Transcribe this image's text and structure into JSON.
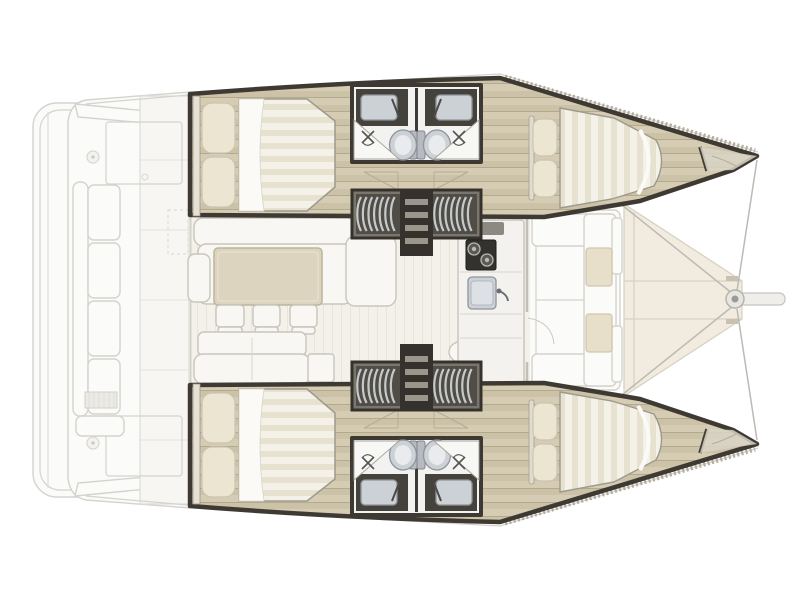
{
  "page": {
    "title": "Catamaran deck and accommodation plan"
  },
  "diagram": {
    "type": "boat-floorplan",
    "vessel": "four-cabin sailing catamaran",
    "view": "overhead plan",
    "orientation": {
      "bow": "right",
      "stern": "left",
      "top_hull": "port",
      "bottom_hull": "starboard"
    },
    "counts": {
      "double_cabins": 4,
      "bathrooms": 4,
      "toilets": 4,
      "showers": 4,
      "sinks": 4,
      "companionway_stairs": 2,
      "galley_burners": 2,
      "salon_stools": 3,
      "fore_cockpit_cushions": 2,
      "aft_bench_cushions": 4
    },
    "areas": {
      "boat": "Catamaran layout plan, bow to the right",
      "swim_platform": "Swim platform",
      "aft_cockpit": "Aft cockpit deck",
      "aft_bench": "Aft cockpit bench seating",
      "aft_wall": "Salon aft bulkhead with sliding door",
      "salon": "Salon",
      "l_sofa": "L-shaped salon sofa",
      "left_armrest": "Sofa end seat",
      "dining_table": "Dining table",
      "stools": "Three stools",
      "aft_sofa": "Aft-facing salon sofa",
      "side_cube": "Side table",
      "oval_seat": "Galley seat",
      "galley": "Galley counter",
      "stove": "Two-burner stove",
      "galley_sink": "Galley sink",
      "port_hull": "Port hull: aft double cabin, twin bathrooms, forward double cabin",
      "starboard_hull": "Starboard hull: aft double cabin, twin bathrooms, forward double cabin",
      "aft_cabin_bed": "Aft double berth with two pillows",
      "forward_cabin_bed": "Forward double berth with two pillows",
      "bathroom_block": "Back-to-back bathrooms with sinks, toilets and showers",
      "stairs": "Companionway steps down into hull",
      "fore_cockpit": "Forward cockpit lounge with cushions",
      "foredeck": "Foredeck between hulls",
      "bowsprit": "Bowsprit fitting and rigging lines"
    }
  },
  "colors": {
    "wall": "#3e3a33",
    "wood": "#cbc2a7",
    "woodLight": "#d5ccb3",
    "woodLine": "#b3a98c",
    "mattress": "#f4f1e8",
    "mattressStripe": "#e7e1cf",
    "pillow": "#ece5d2",
    "pillowEdge": "#cbc4b0",
    "salonFloor": "#f3f1ea",
    "salonStripe": "#e8e5db",
    "sofa": "#f8f7f3",
    "sofaEdge": "#c8c5bc",
    "table": "#dcd4bf",
    "tableEdge": "#bdb49c",
    "cushion": "#e7dfc9",
    "cushionEdge": "#cfc5aa",
    "fixture": "#ccd1d6",
    "fixtureEdge": "#8f949b",
    "stairDark": "#504d47",
    "stairFrame": "#35322d",
    "stairTread": "#c6c9cb",
    "deckFill": "#fbfbf9",
    "deckLine": "#d4d3ce",
    "foredeck": "#f1ecdf",
    "foredeckLine": "#d8d2c2",
    "rig": "#bdbab3",
    "stove": "#33322e",
    "toerail": "#b3ac9d"
  }
}
